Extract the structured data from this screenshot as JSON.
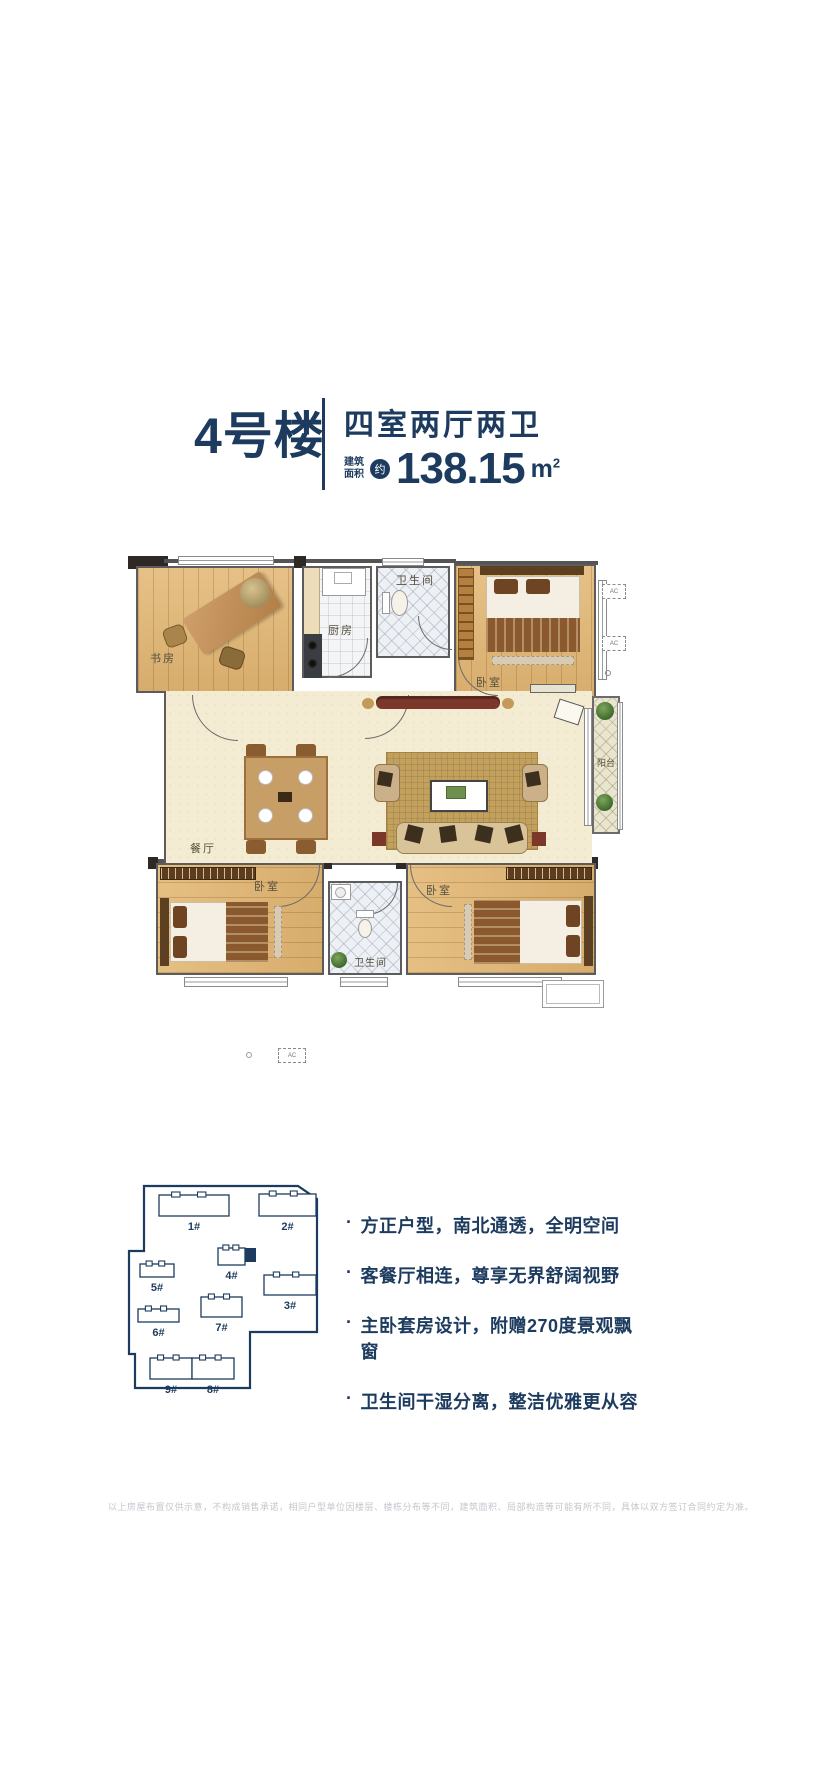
{
  "header": {
    "building_name": "4号楼",
    "unit_type": "四室两厅两卫",
    "area_label_line1": "建筑",
    "area_label_line2": "面积",
    "area_approx_badge": "约",
    "area_value": "138.15",
    "area_unit": "m",
    "area_unit_sup": "2"
  },
  "floor_plan": {
    "rooms": [
      {
        "name": "study",
        "label": "书房"
      },
      {
        "name": "kitchen",
        "label": "厨房"
      },
      {
        "name": "bathroom-1",
        "label": "卫生间"
      },
      {
        "name": "bedroom-1",
        "label": "卧室"
      },
      {
        "name": "dining",
        "label": "餐厅"
      },
      {
        "name": "balcony",
        "label": "阳台"
      },
      {
        "name": "bedroom-2",
        "label": "卧室"
      },
      {
        "name": "bathroom-2",
        "label": "卫生间"
      },
      {
        "name": "bedroom-3",
        "label": "卧室"
      }
    ],
    "ac_label": "AC"
  },
  "site_plan": {
    "boundary": [
      [
        32,
        4
      ],
      [
        186,
        4
      ],
      [
        205,
        17
      ],
      [
        205,
        150
      ],
      [
        138,
        150
      ],
      [
        138,
        206
      ],
      [
        23,
        206
      ],
      [
        23,
        172
      ],
      [
        17,
        172
      ],
      [
        17,
        69
      ],
      [
        32,
        69
      ]
    ],
    "buildings": [
      {
        "label": "1#",
        "x": 47,
        "y": 13,
        "w": 70,
        "h": 21
      },
      {
        "label": "2#",
        "x": 147,
        "y": 12,
        "w": 57,
        "h": 22
      },
      {
        "label": "4#",
        "x": 106,
        "y": 66,
        "w": 27,
        "h": 17
      },
      {
        "label": "5#",
        "x": 28,
        "y": 82,
        "w": 34,
        "h": 13
      },
      {
        "label": "3#",
        "x": 152,
        "y": 93,
        "w": 52,
        "h": 20
      },
      {
        "label": "7#",
        "x": 89,
        "y": 115,
        "w": 41,
        "h": 20
      },
      {
        "label": "6#",
        "x": 26,
        "y": 127,
        "w": 41,
        "h": 13
      },
      {
        "label": "9#",
        "x": 38,
        "y": 176,
        "w": 42,
        "h": 21
      },
      {
        "label": "8#",
        "x": 80,
        "y": 176,
        "w": 42,
        "h": 21
      }
    ],
    "highlight": {
      "x": 133,
      "y": 66,
      "w": 11,
      "h": 14,
      "on_building": "4#"
    }
  },
  "features": [
    "方正户型，南北通透，全明空间",
    "客餐厅相连，尊享无界舒阔视野",
    "主卧套房设计，附赠270度景观飘窗",
    "卫生间干湿分离，整洁优雅更从容"
  ],
  "features_bullet": "·",
  "disclaimer": "以上房屋布置仅供示意，不构成销售承诺，相同户型单位因楼层、楼栋分布等不同，建筑面积、局部构造等可能有所不同，具体以双方签订合同约定为准。",
  "colors": {
    "navy": "#1d3b5e",
    "wall_gray": "#5c5c5c",
    "wood": "#e2b672",
    "living_floor": "#f3ecd2"
  }
}
